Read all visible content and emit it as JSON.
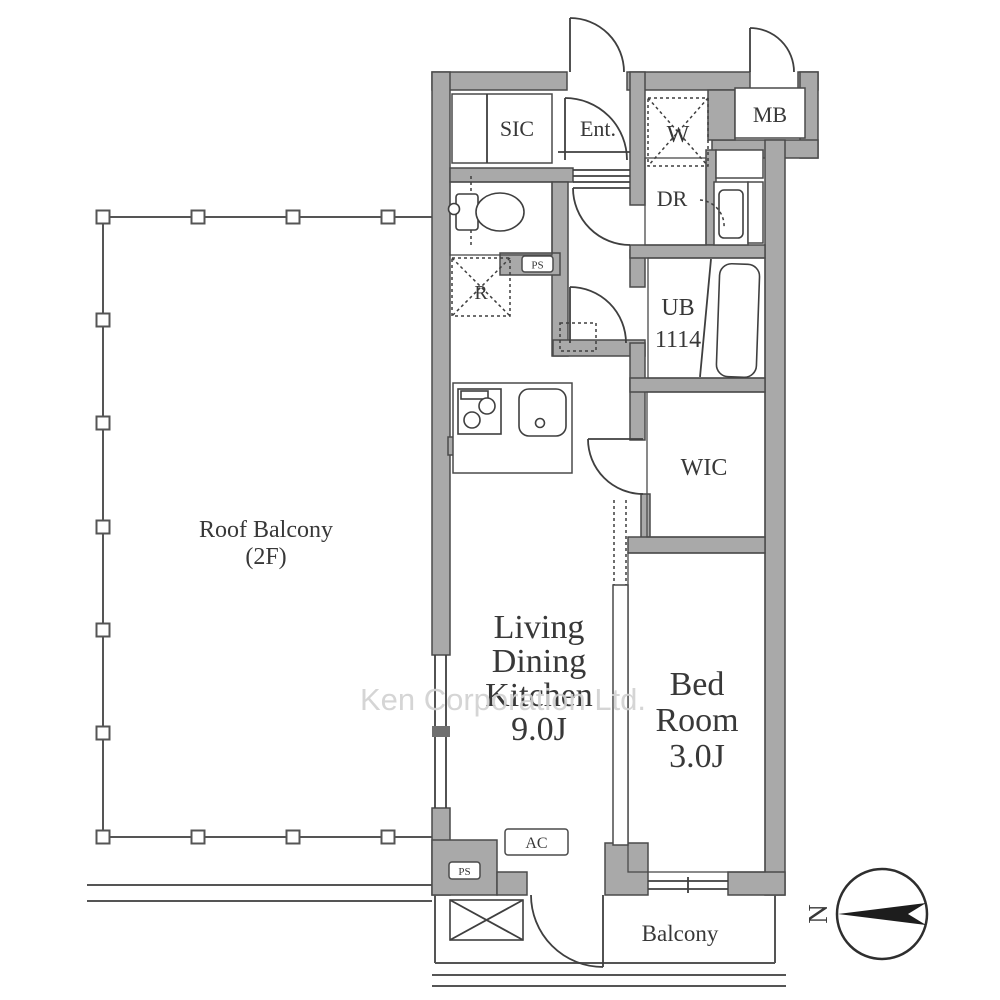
{
  "document": {
    "type": "floor-plan",
    "watermark": "Ken Corporation Ltd."
  },
  "rooms": {
    "sic": {
      "label": "SIC"
    },
    "entrance": {
      "label": "Ent."
    },
    "washer_space": {
      "label": "W"
    },
    "meter_box": {
      "label": "MB"
    },
    "dressing_room": {
      "label": "DR"
    },
    "refrigerator_space": {
      "label": "R"
    },
    "unit_bath": {
      "label": "UB",
      "size": "1114"
    },
    "walk_in_closet": {
      "label": "WIC"
    },
    "living_dining_kitchen": {
      "line1": "Living",
      "line2": "Dining",
      "line3": "Kitchen",
      "size": "9.0J"
    },
    "bedroom": {
      "line1": "Bed",
      "line2": "Room",
      "size": "3.0J"
    },
    "balcony": {
      "label": "Balcony"
    },
    "roof_balcony": {
      "label": "Roof Balcony",
      "floor": "(2F)"
    }
  },
  "annotations": {
    "ac_unit": "AC",
    "pipe_space_upper": "PS",
    "pipe_space_lower": "PS"
  },
  "compass": {
    "north": "N"
  },
  "colors": {
    "wall_fill": "#a9a9a9",
    "wall_stroke": "#4a4a4a",
    "line": "#3f3f3f",
    "text": "#383838",
    "watermark": "#d2d2d2",
    "background": "#ffffff"
  }
}
